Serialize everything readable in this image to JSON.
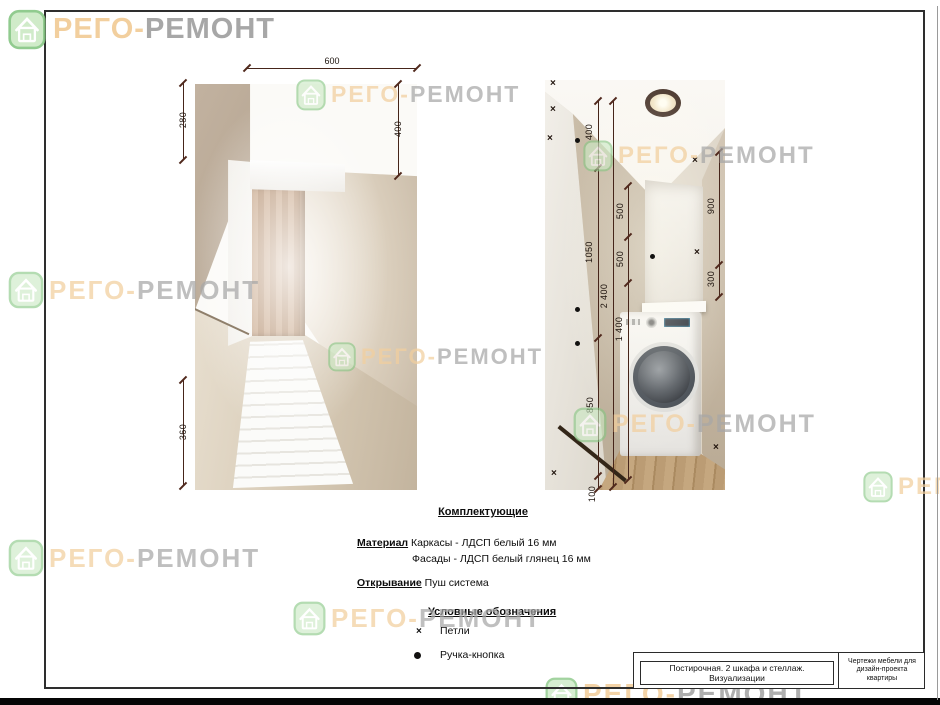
{
  "brand": {
    "first": "РЕГО-",
    "second": "РЕМОНТ"
  },
  "left_view": {
    "dims": {
      "width": "600",
      "upper_left": "280",
      "inner_height": "400",
      "lower_left": "360"
    }
  },
  "right_view": {
    "dims": {
      "seg_400": "400",
      "seg_1050": "1050",
      "seg_850": "850",
      "seg_100": "100",
      "total": "2 400",
      "shelf_500a": "500",
      "shelf_500b": "500",
      "niche_1400": "1 400",
      "right_900": "900",
      "right_300": "300"
    }
  },
  "specs": {
    "components_title": "Комплектующие",
    "material_label": "Материал",
    "material_frames": "Каркасы - ЛДСП белый 16 мм",
    "material_facades": "Фасады - ЛДСП белый глянец 16 мм",
    "opening_label": "Открывание",
    "opening_value": "Пуш система"
  },
  "legend": {
    "title": "Условные обозначения",
    "items": [
      {
        "symbol": "×",
        "label": "Петли"
      },
      {
        "symbol": "●",
        "label": "Ручка-кнопка"
      }
    ]
  },
  "title_block": {
    "project": "Постирочная. 2 шкафа и стеллаж. Визуализации",
    "doc_lines": [
      "Чертежи мебели для",
      "дизайн-проекта",
      "квартиры"
    ]
  },
  "colors": {
    "accent_orange": "#f2cf9e",
    "accent_gray": "#a7a7a7",
    "icon_green": "#cbe9c4",
    "dim_line": "#46251a"
  }
}
